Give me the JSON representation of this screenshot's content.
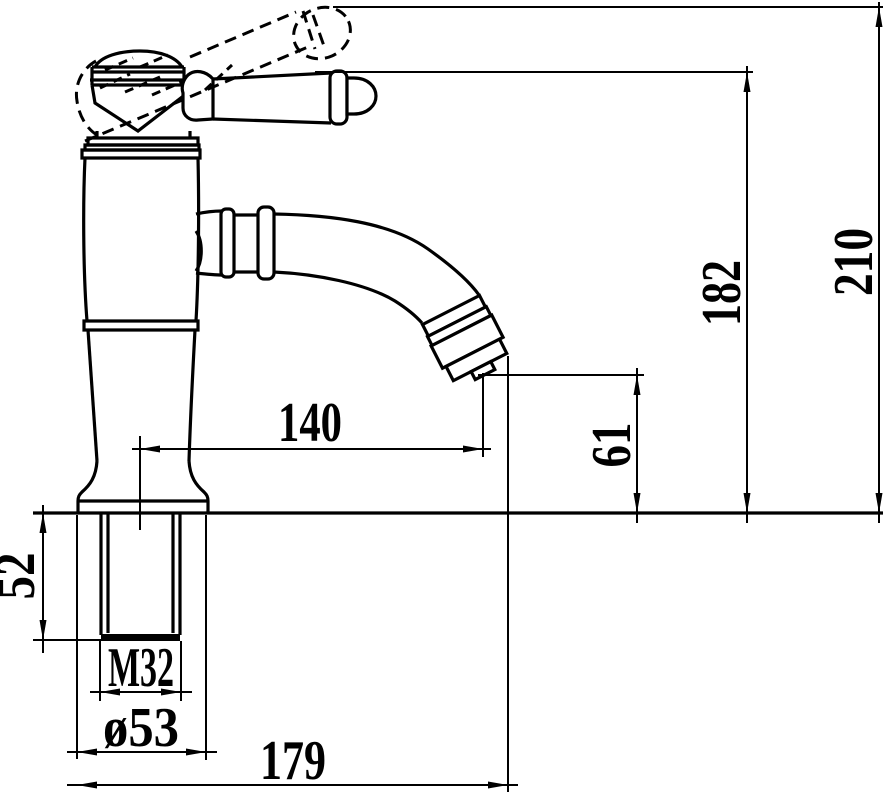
{
  "colors": {
    "ink": "#000000",
    "paper": "#ffffff"
  },
  "labels": {
    "overall_height": "210",
    "handle_height": "182",
    "outlet_height": "61",
    "spout_reach": "140",
    "shank_depth": "52",
    "thread_size": "M32",
    "base_diameter": "ø53",
    "overall_length": "179"
  }
}
